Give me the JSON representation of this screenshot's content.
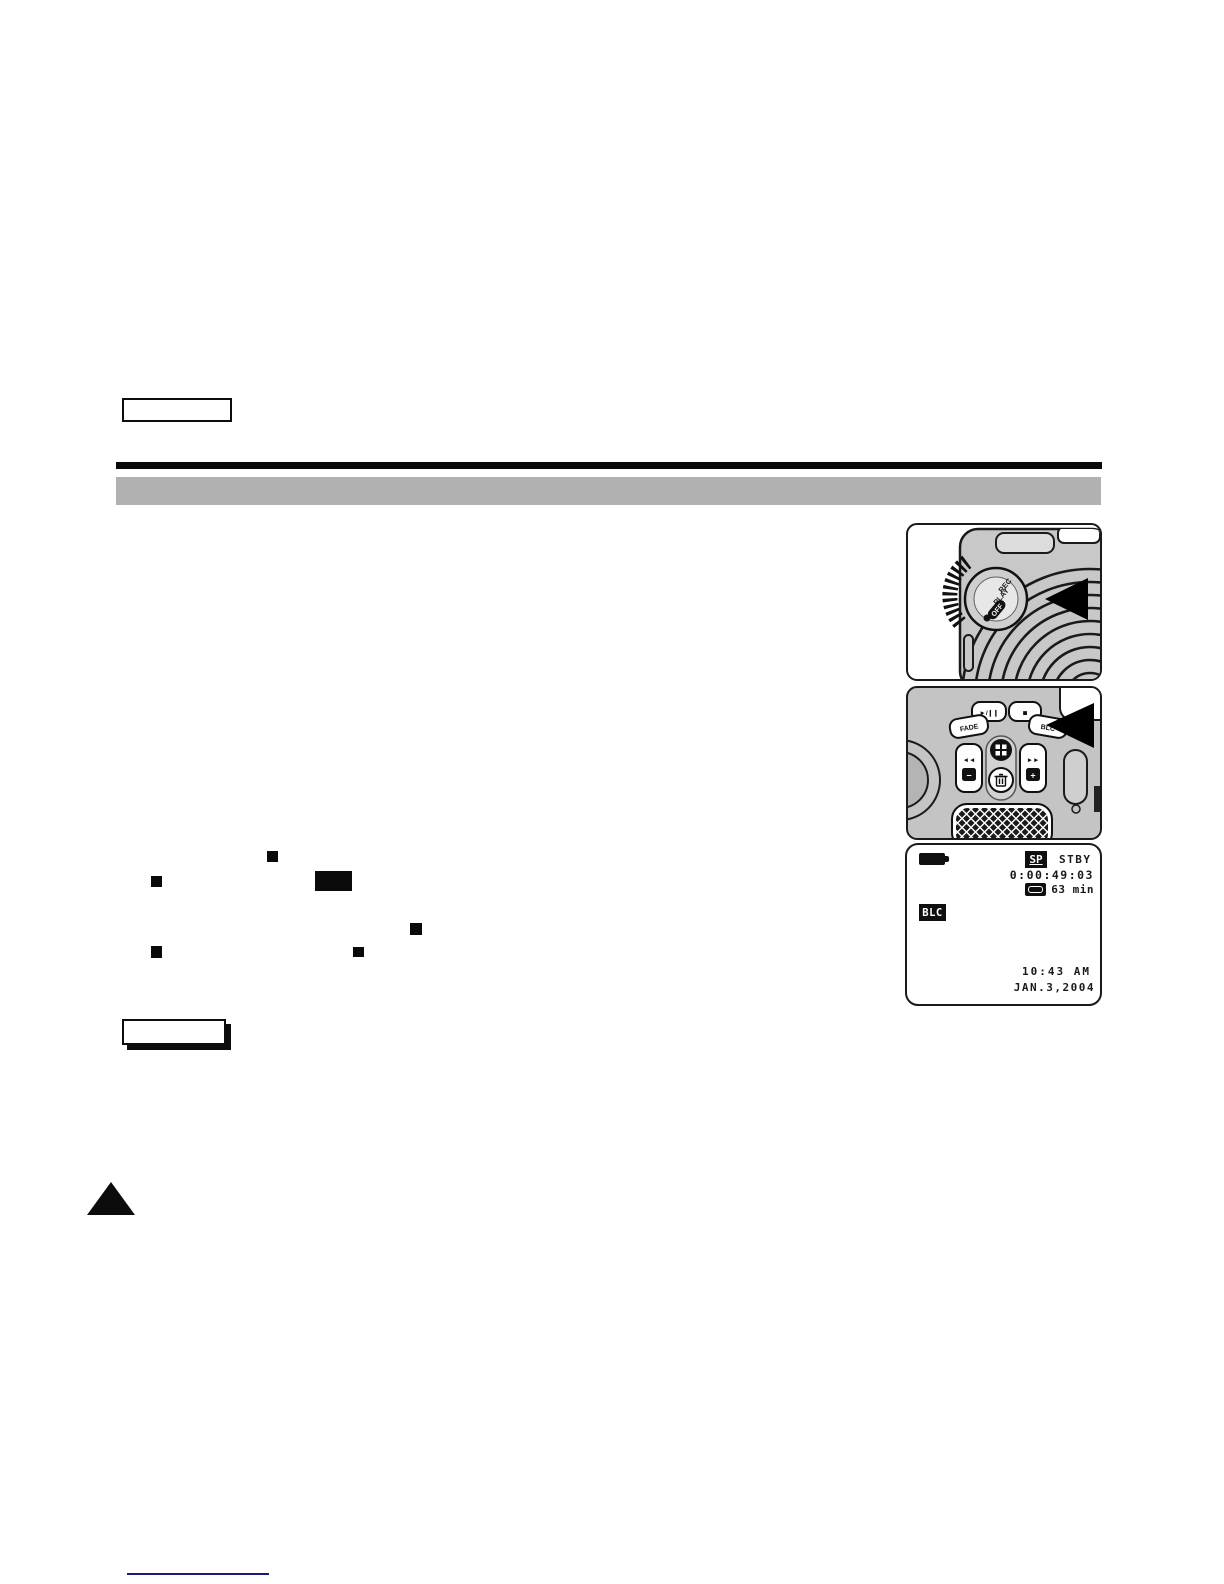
{
  "figures": {
    "mode_dial": {
      "dial_labels": {
        "rec": "REC",
        "play": "PLAY",
        "off": "OFF"
      }
    },
    "button_panel": {
      "buttons": {
        "fade": "FADE",
        "play_pause": "►/❙❙",
        "stop": "■",
        "blc": "BLC",
        "rewind": "◄◄",
        "forward": "►►",
        "minus": "−",
        "plus": "+"
      }
    },
    "osd_display": {
      "record_speed": "SP",
      "status": "STBY",
      "timecode": "0:00:49:03",
      "tape_remaining": "63 min",
      "blc_indicator": "BLC",
      "time": "10:43 AM",
      "date": "JAN.3,2004"
    }
  },
  "colors": {
    "header_bar": "#b1b1b1",
    "footer_line": "#19197f",
    "camcorder_gray": "#c8c8c8",
    "ink": "#111111"
  }
}
